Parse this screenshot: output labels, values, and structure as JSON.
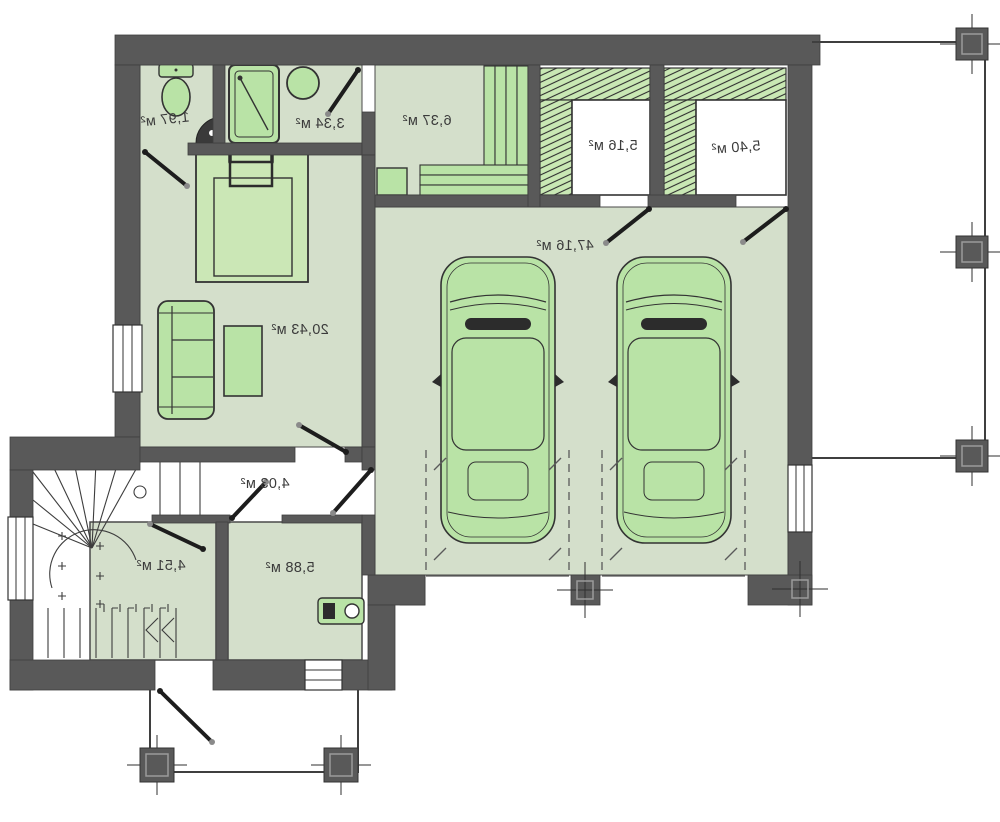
{
  "plan": {
    "area_unit": "м²",
    "rooms": [
      {
        "name": "wc",
        "area": "1,97 м²"
      },
      {
        "name": "bathroom",
        "area": "3,34 м²"
      },
      {
        "name": "sauna",
        "area": "6,37 м²"
      },
      {
        "name": "wardrobe-1",
        "area": "5,16 м²"
      },
      {
        "name": "wardrobe-2",
        "area": "5,40 м²"
      },
      {
        "name": "garage",
        "area": "47,16 м²"
      },
      {
        "name": "living-room",
        "area": "20,43 м²"
      },
      {
        "name": "hallway",
        "area": "4,03 м²"
      },
      {
        "name": "storage-room",
        "area": "4,51 м²"
      },
      {
        "name": "boiler-room",
        "area": "5,88 м²"
      }
    ],
    "icons": [
      "toilet-icon",
      "shower-cabin-icon",
      "round-sink-icon",
      "corner-sink-icon",
      "double-bed-icon",
      "sofa-icon",
      "coffee-table-icon",
      "sauna-bench-icon",
      "sauna-stove-icon",
      "car-icon",
      "boiler-icon",
      "winder-stairs-icon",
      "door-swing-icon",
      "window-icon",
      "column-marker-icon"
    ],
    "colors": {
      "wall": "#595959",
      "room_floor": "#d4dfcb",
      "furniture_fill": "#b9e3a6",
      "wardrobe_band": "#c9e8b4",
      "bed_fill": "#cbe7b6",
      "outline": "#333333",
      "label_text": "#3b3b3b",
      "background": "#ffffff"
    }
  }
}
